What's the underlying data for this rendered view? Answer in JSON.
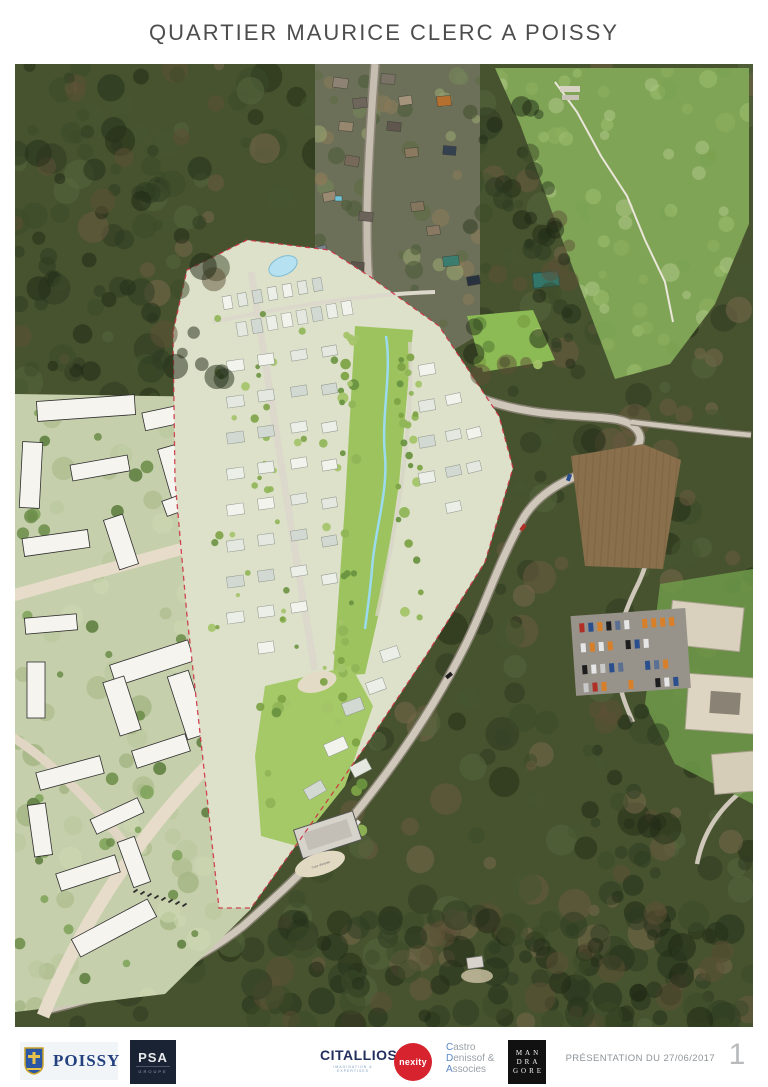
{
  "page": {
    "title": "QUARTIER MAURICE CLERC A POISSY",
    "footer": {
      "presentation_label": "PRÉSENTATION DU 27/06/2017",
      "page_number": "1"
    }
  },
  "map": {
    "labels": {
      "courtyard": "Cour d'entrée"
    }
  },
  "logos": {
    "poissy": {
      "name": "POISSY"
    },
    "psa": {
      "name": "PSA",
      "subtitle": "GROUPE"
    },
    "citallios": {
      "name": "CITALLIOS",
      "tagline": "IMAGINATION & EXPERTISES"
    },
    "nexity": {
      "name": "nexity"
    },
    "castro": {
      "initials": [
        "C",
        "D",
        "A"
      ],
      "rests": [
        "astro",
        "enissof &",
        "ssocies"
      ]
    },
    "mandragore": {
      "lines": [
        "MAN",
        "DRA",
        "GORE"
      ]
    }
  },
  "colors": {
    "poissy_blue": "#23407f",
    "psa_navy": "#1a2333",
    "citallios_navy": "#232f5c",
    "nexity_red": "#d6232e",
    "mandragore_black": "#111111",
    "site_boundary_red": "#cc3344",
    "stream_blue": "#9adbed",
    "park_green": "#9dc35f"
  }
}
